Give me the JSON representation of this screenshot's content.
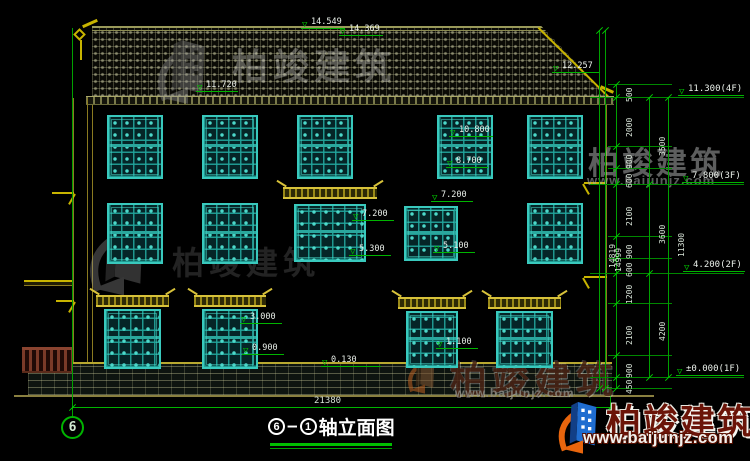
{
  "watermark": {
    "brand": "柏竣建筑",
    "url": "www.baijunjz.com"
  },
  "title": {
    "bubble": "6",
    "from": "6",
    "to": "1",
    "dash": "—",
    "name": "轴立面图"
  },
  "bottom": {
    "total_width": "21380"
  },
  "drawing": {
    "windows": [
      {
        "x": 107,
        "y": 115,
        "w": 56,
        "h": 64
      },
      {
        "x": 202,
        "y": 115,
        "w": 56,
        "h": 64
      },
      {
        "x": 297,
        "y": 115,
        "w": 56,
        "h": 64
      },
      {
        "x": 437,
        "y": 115,
        "w": 56,
        "h": 64
      },
      {
        "x": 527,
        "y": 115,
        "w": 56,
        "h": 64
      },
      {
        "x": 107,
        "y": 203,
        "w": 56,
        "h": 61
      },
      {
        "x": 202,
        "y": 203,
        "w": 56,
        "h": 61
      },
      {
        "x": 294,
        "y": 204,
        "w": 72,
        "h": 58
      },
      {
        "x": 404,
        "y": 206,
        "w": 54,
        "h": 55
      },
      {
        "x": 527,
        "y": 203,
        "w": 56,
        "h": 61
      },
      {
        "x": 104,
        "y": 309,
        "w": 57,
        "h": 60
      },
      {
        "x": 202,
        "y": 309,
        "w": 56,
        "h": 60
      },
      {
        "x": 406,
        "y": 311,
        "w": 52,
        "h": 57
      },
      {
        "x": 496,
        "y": 311,
        "w": 57,
        "h": 57
      }
    ],
    "canopies": [
      {
        "x": 283,
        "y": 187,
        "w": 94
      },
      {
        "x": 96,
        "y": 295,
        "w": 73
      },
      {
        "x": 194,
        "y": 295,
        "w": 72
      },
      {
        "x": 398,
        "y": 297,
        "w": 68
      },
      {
        "x": 488,
        "y": 297,
        "w": 73
      }
    ],
    "markers": [
      {
        "label": "14.549",
        "x": 301,
        "line_y": 29,
        "w": 44
      },
      {
        "label": "14.369",
        "x": 339,
        "line_y": 36,
        "w": 44
      },
      {
        "label": "12.257",
        "x": 552,
        "line_y": 73,
        "w": 48
      },
      {
        "label": "11.720",
        "x": 196,
        "line_y": 92,
        "w": 42
      },
      {
        "label": "10.800",
        "x": 449,
        "line_y": 137,
        "w": 44
      },
      {
        "label": "8.700",
        "x": 446,
        "line_y": 168,
        "w": 42
      },
      {
        "label": "7.200",
        "x": 352,
        "line_y": 221,
        "w": 42
      },
      {
        "label": "5.300",
        "x": 349,
        "line_y": 256,
        "w": 42
      },
      {
        "label": "7.200",
        "x": 431,
        "line_y": 202,
        "w": 42
      },
      {
        "label": "5.100",
        "x": 433,
        "line_y": 253,
        "w": 42
      },
      {
        "label": "3.000",
        "x": 240,
        "line_y": 324,
        "w": 42
      },
      {
        "label": "0.900",
        "x": 242,
        "line_y": 355,
        "w": 42
      },
      {
        "label": "1.100",
        "x": 436,
        "line_y": 349,
        "w": 42
      },
      {
        "label": "0.130",
        "x": 321,
        "line_y": 367,
        "w": 60
      }
    ],
    "floor_marks": [
      {
        "label": "11.300(4F)",
        "x": 678,
        "line_y": 97,
        "w": 66
      },
      {
        "label": "7.800(3F)",
        "x": 682,
        "line_y": 184,
        "w": 62
      },
      {
        "label": "4.200(2F)",
        "x": 683,
        "line_y": 273,
        "w": 62
      },
      {
        "label": "±0.000(1F)",
        "x": 676,
        "line_y": 377,
        "w": 68
      }
    ],
    "chains": [
      {
        "x": 616,
        "boundaries": [
          84,
          97,
          146,
          168,
          184,
          236,
          258,
          273,
          303,
          355,
          377,
          388
        ],
        "labels": [
          {
            "v": "500",
            "y": 90
          },
          {
            "v": "2000",
            "y": 121
          },
          {
            "v": "900",
            "y": 157
          },
          {
            "v": "600",
            "y": 176
          },
          {
            "v": "2100",
            "y": 210
          },
          {
            "v": "900",
            "y": 247
          },
          {
            "v": "600",
            "y": 265
          },
          {
            "v": "1200",
            "y": 288
          },
          {
            "v": "2100",
            "y": 329
          },
          {
            "v": "900",
            "y": 366
          },
          {
            "v": "450",
            "y": 382
          }
        ]
      },
      {
        "x": 649,
        "boundaries": [
          97,
          184,
          273,
          377
        ],
        "labels": [
          {
            "v": "3500",
            "y": 140
          },
          {
            "v": "3600",
            "y": 228
          },
          {
            "v": "4200",
            "y": 325
          }
        ]
      },
      {
        "x": 668,
        "boundaries": [
          97,
          377
        ],
        "labels": [
          {
            "v": "11300",
            "y": 237
          }
        ]
      },
      {
        "x": 599,
        "boundaries": [
          30,
          388
        ],
        "labels": [
          {
            "v": "14819",
            "y": 248
          }
        ]
      },
      {
        "x": 605,
        "boundaries": [
          30,
          388
        ],
        "labels": [
          {
            "v": "14999",
            "y": 252
          }
        ]
      }
    ],
    "ext_lines": [
      {
        "y": 97,
        "x1": 590,
        "x2": 744
      },
      {
        "y": 184,
        "x1": 590,
        "x2": 744
      },
      {
        "y": 273,
        "x1": 590,
        "x2": 744
      },
      {
        "y": 377,
        "x1": 590,
        "x2": 744
      },
      {
        "y": 84,
        "x1": 608,
        "x2": 672
      },
      {
        "y": 146,
        "x1": 608,
        "x2": 672
      },
      {
        "y": 168,
        "x1": 608,
        "x2": 672
      },
      {
        "y": 236,
        "x1": 608,
        "x2": 672
      },
      {
        "y": 258,
        "x1": 608,
        "x2": 672
      },
      {
        "y": 303,
        "x1": 608,
        "x2": 672
      },
      {
        "y": 355,
        "x1": 608,
        "x2": 672
      },
      {
        "y": 388,
        "x1": 608,
        "x2": 672
      }
    ]
  }
}
